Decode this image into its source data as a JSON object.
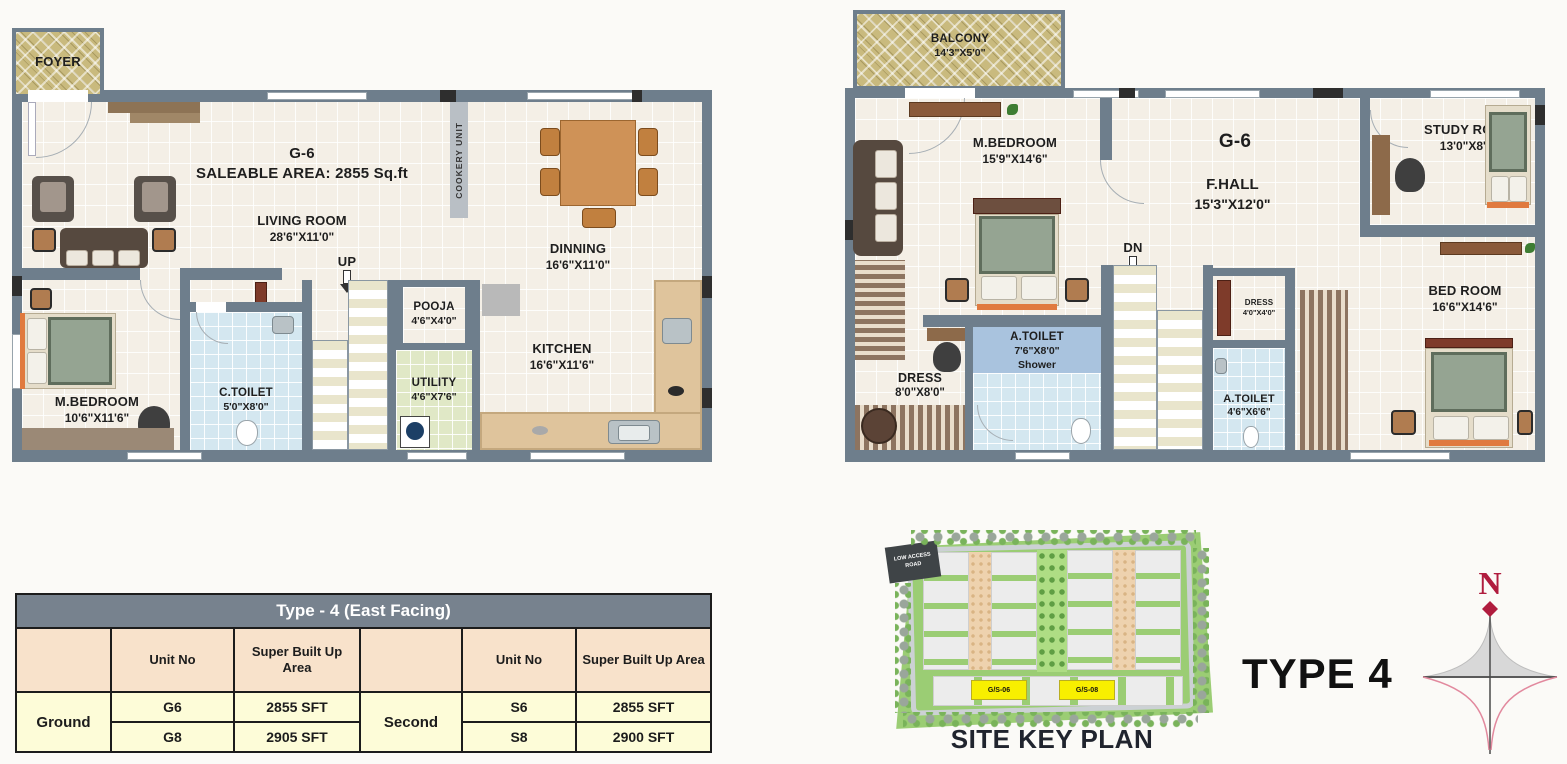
{
  "ground_plan": {
    "unit": "G-6",
    "area_line": "SALEABLE AREA: 2855 Sq.ft",
    "foyer": "FOYER",
    "cookery": "COOKERY UNIT",
    "stairs": "UP",
    "living": {
      "name": "LIVING ROOM",
      "dims": "28'6\"X11'0\""
    },
    "dinning": {
      "name": "DINNING",
      "dims": "16'6\"X11'0\""
    },
    "kitchen": {
      "name": "KITCHEN",
      "dims": "16'6\"X11'6\""
    },
    "mbedroom": {
      "name": "M.BEDROOM",
      "dims": "10'6\"X11'6\""
    },
    "ctoilet": {
      "name": "C.TOILET",
      "dims": "5'0\"X8'0\""
    },
    "pooja": {
      "name": "POOJA",
      "dims": "4'6\"X4'0\""
    },
    "utility": {
      "name": "UTILITY",
      "dims": "4'6\"X7'6\""
    }
  },
  "second_plan": {
    "unit": "G-6",
    "stairs": "DN",
    "balcony": {
      "name": "BALCONY",
      "dims": "14'3\"X5'0\""
    },
    "mbedroom": {
      "name": "M.BEDROOM",
      "dims": "15'9\"X14'6\""
    },
    "fhall": {
      "name": "F.HALL",
      "dims": "15'3\"X12'0\""
    },
    "study": {
      "name": "STUDY ROOM",
      "dims": "13'0\"X8'0\""
    },
    "bedroom": {
      "name": "BED ROOM",
      "dims": "16'6\"X14'6\""
    },
    "atoilet1": {
      "name": "A.TOILET",
      "dims": "7'6\"X8'0\"",
      "note": "Shower"
    },
    "dress1": {
      "name": "DRESS",
      "dims": "8'0\"X8'0\""
    },
    "dress2": {
      "name": "DRESS",
      "dims": "4'0\"X4'0\""
    },
    "atoilet2": {
      "name": "A.TOILET",
      "dims": "4'6\"X6'6\""
    }
  },
  "unit_table": {
    "title": "Type - 4 (East Facing)",
    "unit_no_header": "Unit No",
    "area_header": "Super Built Up Area",
    "groups": [
      {
        "label": "Ground",
        "rows": [
          {
            "unit": "G6",
            "area": "2855 SFT"
          },
          {
            "unit": "G8",
            "area": "2905 SFT"
          }
        ]
      },
      {
        "label": "Second",
        "rows": [
          {
            "unit": "S6",
            "area": "2855 SFT"
          },
          {
            "unit": "S8",
            "area": "2900 SFT"
          }
        ]
      }
    ]
  },
  "site_plan": {
    "caption": "SITE KEY PLAN",
    "road_flag": "LOW ACCESS ROAD",
    "tags": [
      "G/S-06",
      "G/S-08"
    ]
  },
  "type_title": "TYPE 4",
  "compass": {
    "north": "N"
  },
  "colors": {
    "wall": "#6e7e8c",
    "floor": "#f4efe6",
    "lattice": "#c9ba7e",
    "toilet_blue": "#d4e7f0",
    "utility_green": "#e0e8c6",
    "table_title_bg": "#77828e",
    "table_header_bg": "#f8e2cb",
    "table_cell_bg": "#fdfcd8",
    "site_green": "#9bcd74",
    "highlight_yellow": "#f8ef00",
    "compass_red": "#b01c3e"
  }
}
